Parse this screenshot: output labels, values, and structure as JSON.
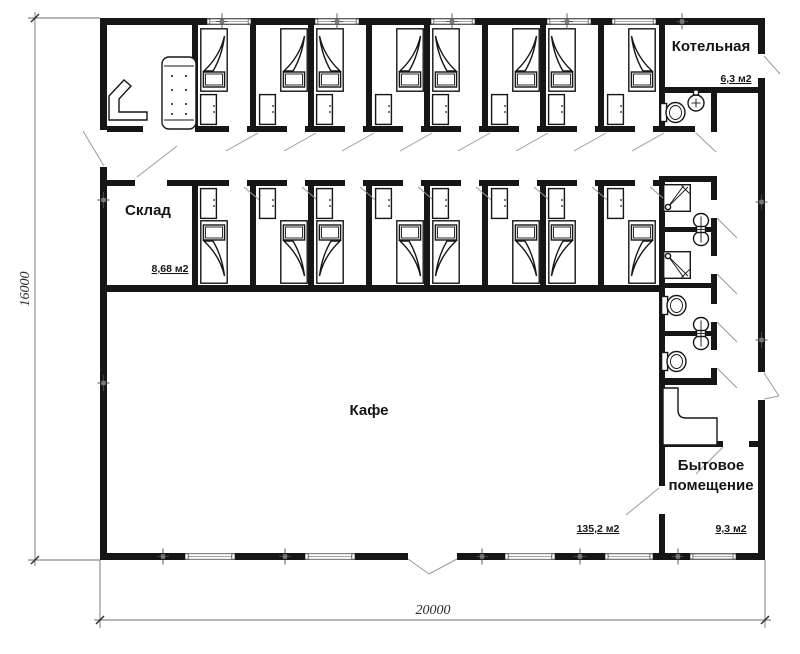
{
  "drawing_title": "floor-plan",
  "rooms": [
    {
      "id": "boiler",
      "label": "Котельная",
      "area": "6,3 м2"
    },
    {
      "id": "storage",
      "label": "Склад",
      "area": "8,68 м2"
    },
    {
      "id": "cafe",
      "label": "Кафе",
      "area": "135,2 м2"
    },
    {
      "id": "utility",
      "label_line1": "Бытовое",
      "label_line2": "помещение",
      "area": "9,3 м2"
    }
  ],
  "dimensions": {
    "bottom_width": "20000",
    "left_height": "16000"
  },
  "colors": {
    "wall": "#161616",
    "background": "#ffffff",
    "door_swing": "#9a9a9a",
    "dimension_line": "#6e6e6e"
  }
}
